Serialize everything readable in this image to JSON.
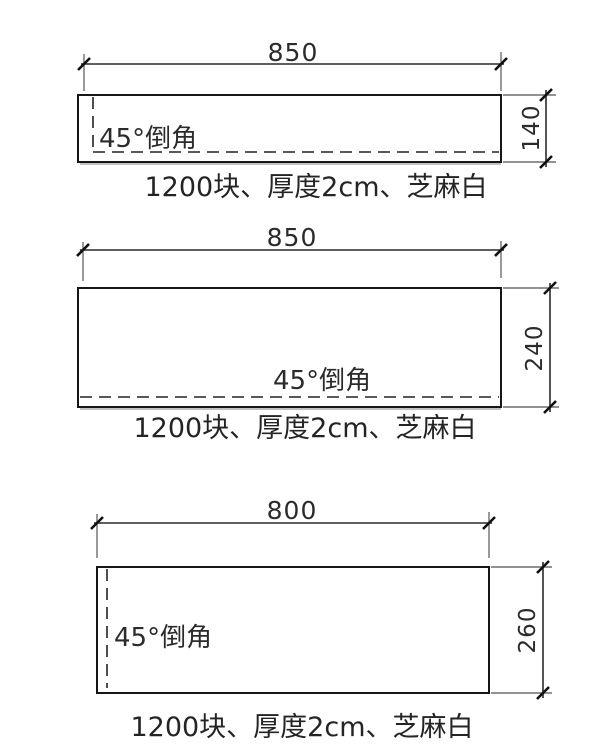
{
  "page": {
    "background_color": "#ffffff",
    "line_color": "#161616",
    "extension_line_color": "#6e6e6e",
    "text_color": "#2b2b2b"
  },
  "panels": [
    {
      "width_label": "850",
      "height_label": "140",
      "chamfer_label": "45°倒角",
      "caption": "1200块、厚度2cm、芝麻白"
    },
    {
      "width_label": "850",
      "height_label": "240",
      "chamfer_label": "45°倒角",
      "caption": "1200块、厚度2cm、芝麻白"
    },
    {
      "width_label": "800",
      "height_label": "260",
      "chamfer_label": "45°倒角",
      "caption": "1200块、厚度2cm、芝麻白"
    }
  ]
}
